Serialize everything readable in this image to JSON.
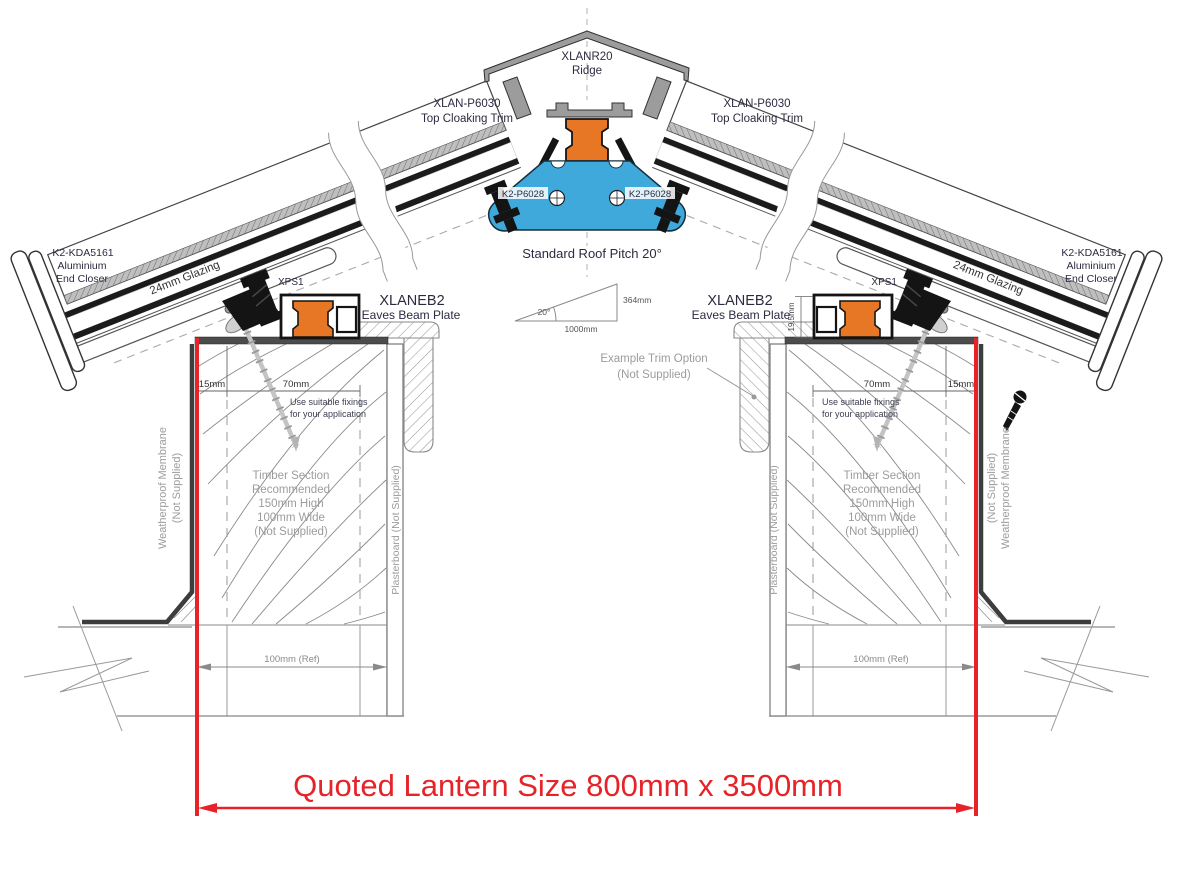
{
  "drawing": {
    "ridge": {
      "part": "XLANR20",
      "name": "Ridge"
    },
    "cloaking_trim": {
      "part": "XLAN-P6030",
      "name": "Top Cloaking Trim"
    },
    "ridge_fixing_part": "K2-P6028",
    "pitch": {
      "title": "Standard Roof Pitch 20°",
      "angle": "20°",
      "run": "1000mm",
      "rise": "364mm"
    },
    "end_closer": {
      "part": "K2-KDA5161",
      "material": "Aluminium",
      "name": "End Closer"
    },
    "glazing_label": "24mm Glazing",
    "gasket_part": "XPS1",
    "eaves_beam": {
      "part": "XLANEB2",
      "name": "Eaves Beam Plate"
    },
    "trim_option": {
      "line1": "Example Trim Option",
      "line2": "(Not Supplied)"
    },
    "fixing_note": {
      "line1": "Use suitable fixings",
      "line2": "for your application"
    },
    "timber_note": {
      "line1": "Timber Section",
      "line2": "Recommended",
      "line3": "150mm High",
      "line4": "100mm Wide",
      "line5": "(Not Supplied)"
    },
    "membrane_note": {
      "line1": "Weatherproof Membrane",
      "line2": "(Not Supplied)"
    },
    "plasterboard_note": "Plasterboard (Not Supplied)",
    "dimensions": {
      "edge": "15mm",
      "fixing_zone": "70mm",
      "beam_height": "19.5mm",
      "kerb_ref": "100mm (Ref)"
    },
    "quoted_size": "Quoted Lantern Size 800mm x 3500mm",
    "colors": {
      "red": "#e52329",
      "orange": "#e87725",
      "blue": "#3fa9dc"
    }
  }
}
